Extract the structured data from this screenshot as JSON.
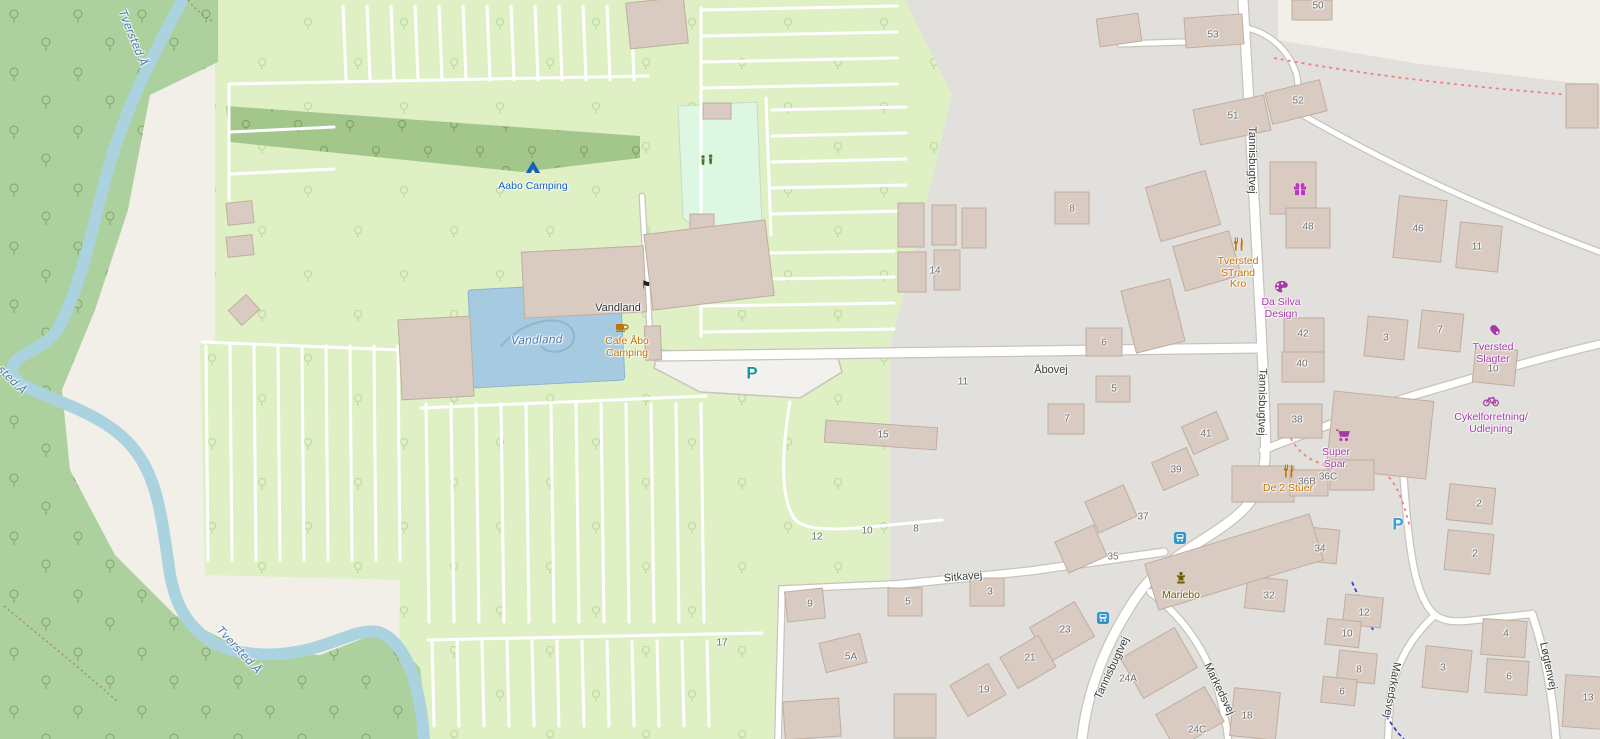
{
  "map": {
    "region_description": "Tversted camping and village street map",
    "colors": {
      "bg": "#f2efe9",
      "residential": "#e2e0dc",
      "camp": "#def0c4",
      "forest": "#add19e",
      "wood": "#a3c68b",
      "pitch": "#def7e2",
      "water": "#aad3df",
      "pool": "#a6cbe1",
      "building": "#d9cbc2",
      "buildingStroke": "#c0ad9d",
      "road": "#ffffff",
      "casing": "#c8c4bb",
      "parkingLot": "#f2f1ed",
      "pathRed": "#f08080",
      "pathBlue": "#3344cc",
      "track": "#ac8c4e",
      "num": "#6e6e6e",
      "roadLabel": "#3c3c3c",
      "waterLabel": "#4a78b0",
      "placeDark": "#333333",
      "poiOrange": "#c27400",
      "poiPurple": "#a53aa5",
      "poiBlue": "#1560bd",
      "poiGold": "#6b5d00",
      "gift": "#c72fc7",
      "tent": "#1d76b0",
      "playground": "#3e7d22",
      "bus": "#2f96c8",
      "statue": "#8a7500",
      "parkingTeal": "#18989e",
      "parkingBlue": "#3aa0d8",
      "treeForest": "#7ea368",
      "treeCamp": "#b9d89c",
      "treeWood": "#7d9c63"
    },
    "road_labels": [
      {
        "text": "Åbovej",
        "x": 1051,
        "y": 370,
        "a": -1
      },
      {
        "text": "Tannisbugtvej",
        "x": 1252,
        "y": 160,
        "a": 90
      },
      {
        "text": "Tannisbugtvej",
        "x": 1262,
        "y": 402,
        "a": 91
      },
      {
        "text": "Tannisbugtvej",
        "x": 1112,
        "y": 668,
        "a": -65
      },
      {
        "text": "Sitkavej",
        "x": 963,
        "y": 577,
        "a": -5
      },
      {
        "text": "Markedsvej",
        "x": 1219,
        "y": 689,
        "a": 64
      },
      {
        "text": "Markedsvej",
        "x": 1392,
        "y": 690,
        "a": 100
      },
      {
        "text": "Løgtenvej",
        "x": 1548,
        "y": 666,
        "a": 78
      }
    ],
    "water_labels": [
      {
        "text": "Tversted Å",
        "x": 133,
        "y": 38,
        "a": 68
      },
      {
        "text": "sted Å",
        "x": 12,
        "y": 380,
        "a": 45
      },
      {
        "text": "Tversted Å",
        "x": 239,
        "y": 650,
        "a": 47
      },
      {
        "text": "Vandland",
        "x": 537,
        "y": 340,
        "a": -2
      }
    ],
    "pois": [
      {
        "name": "aabo-camping",
        "icon": "tent-icon",
        "ix": 533,
        "iy": 167,
        "lines": [
          "Aabo Camping"
        ],
        "x": 533,
        "y": 186,
        "ck": "poiBlue"
      },
      {
        "name": "vandland-place",
        "lines": [
          "Vandland"
        ],
        "x": 618,
        "y": 308,
        "ck": "placeDark"
      },
      {
        "name": "cafe-abo-camping",
        "icon": "cafe-icon",
        "ix": 622,
        "iy": 327,
        "lines": [
          "Cafe Åbo",
          "Camping"
        ],
        "x": 627,
        "y": 341,
        "ck": "poiOrange"
      },
      {
        "name": "tversted-strand-kro",
        "icon": "restaurant-icon",
        "ix": 1238,
        "iy": 244,
        "lines": [
          "Tversted",
          "STrand",
          "Kro"
        ],
        "x": 1238,
        "y": 261,
        "ck": "poiOrange"
      },
      {
        "name": "da-silva-design",
        "icon": "palette-icon",
        "ix": 1281,
        "iy": 287,
        "lines": [
          "Da Silva",
          "Design"
        ],
        "x": 1281,
        "y": 302,
        "ck": "poiPurple"
      },
      {
        "name": "tversted-slagter",
        "icon": "butcher-icon",
        "ix": 1495,
        "iy": 330,
        "lines": [
          "Tversted",
          "Slagter"
        ],
        "x": 1493,
        "y": 347,
        "ck": "poiPurple"
      },
      {
        "name": "cykelforretning-udlejning",
        "icon": "bicycle-icon",
        "ix": 1491,
        "iy": 401,
        "lines": [
          "Cykelforretning/",
          "Udlejning"
        ],
        "x": 1491,
        "y": 417,
        "ck": "poiPurple"
      },
      {
        "name": "super-spar",
        "icon": "cart-icon",
        "ix": 1343,
        "iy": 435,
        "lines": [
          "Super",
          "Spar."
        ],
        "x": 1336,
        "y": 452,
        "ck": "poiPurple"
      },
      {
        "name": "de-2-stuer",
        "icon": "restaurant-icon",
        "ix": 1288,
        "iy": 471,
        "lines": [
          "De 2 Stuer"
        ],
        "x": 1288,
        "y": 488,
        "ck": "poiOrange"
      },
      {
        "name": "mariebo",
        "icon": "statue-icon",
        "ix": 1181,
        "iy": 578,
        "lines": [
          "Mariebo"
        ],
        "x": 1181,
        "y": 595,
        "ck": "poiGold"
      }
    ],
    "standalone_icons": [
      {
        "name": "playground-icon",
        "x": 707,
        "y": 160
      },
      {
        "name": "gift-icon",
        "x": 1300,
        "y": 189
      },
      {
        "name": "flag-icon",
        "x": 646,
        "y": 286,
        "glyph": "⚑"
      },
      {
        "name": "parking-icon",
        "x": 752,
        "y": 373,
        "glyph": "P",
        "ck": "parkingTeal"
      },
      {
        "name": "parking-icon",
        "x": 1398,
        "y": 524,
        "glyph": "P",
        "ck": "parkingBlue"
      },
      {
        "name": "bus-stop-icon",
        "x": 1180,
        "y": 538
      },
      {
        "name": "bus-stop-icon",
        "x": 1103,
        "y": 618
      }
    ],
    "house_numbers": [
      {
        "n": "53",
        "x": 1213,
        "y": 35
      },
      {
        "n": "50",
        "x": 1318,
        "y": 6
      },
      {
        "n": "52",
        "x": 1298,
        "y": 101
      },
      {
        "n": "51",
        "x": 1233,
        "y": 116
      },
      {
        "n": "8",
        "x": 1072,
        "y": 209
      },
      {
        "n": "48",
        "x": 1308,
        "y": 227
      },
      {
        "n": "46",
        "x": 1418,
        "y": 229
      },
      {
        "n": "11",
        "x": 1477,
        "y": 247
      },
      {
        "n": "14",
        "x": 935,
        "y": 271
      },
      {
        "n": "42",
        "x": 1303,
        "y": 334
      },
      {
        "n": "3",
        "x": 1386,
        "y": 338
      },
      {
        "n": "7",
        "x": 1440,
        "y": 330
      },
      {
        "n": "40",
        "x": 1302,
        "y": 364
      },
      {
        "n": "6",
        "x": 1104,
        "y": 343
      },
      {
        "n": "11",
        "x": 963,
        "y": 382
      },
      {
        "n": "5",
        "x": 1114,
        "y": 389
      },
      {
        "n": "10",
        "x": 1493,
        "y": 369
      },
      {
        "n": "38",
        "x": 1297,
        "y": 420
      },
      {
        "n": "7",
        "x": 1067,
        "y": 419
      },
      {
        "n": "41",
        "x": 1206,
        "y": 434
      },
      {
        "n": "15",
        "x": 883,
        "y": 435
      },
      {
        "n": "39",
        "x": 1176,
        "y": 470
      },
      {
        "n": "36B",
        "x": 1307,
        "y": 482
      },
      {
        "n": "36C",
        "x": 1328,
        "y": 477
      },
      {
        "n": "2",
        "x": 1479,
        "y": 504
      },
      {
        "n": "37",
        "x": 1143,
        "y": 517
      },
      {
        "n": "12",
        "x": 817,
        "y": 537
      },
      {
        "n": "10",
        "x": 867,
        "y": 531
      },
      {
        "n": "8",
        "x": 916,
        "y": 529
      },
      {
        "n": "35",
        "x": 1113,
        "y": 557
      },
      {
        "n": "34",
        "x": 1320,
        "y": 549
      },
      {
        "n": "3",
        "x": 990,
        "y": 592
      },
      {
        "n": "2",
        "x": 1475,
        "y": 554
      },
      {
        "n": "9",
        "x": 810,
        "y": 604
      },
      {
        "n": "5",
        "x": 908,
        "y": 602
      },
      {
        "n": "32",
        "x": 1269,
        "y": 596
      },
      {
        "n": "12",
        "x": 1364,
        "y": 613
      },
      {
        "n": "10",
        "x": 1347,
        "y": 634
      },
      {
        "n": "23",
        "x": 1065,
        "y": 630
      },
      {
        "n": "21",
        "x": 1030,
        "y": 658
      },
      {
        "n": "5A",
        "x": 851,
        "y": 657
      },
      {
        "n": "17",
        "x": 722,
        "y": 643
      },
      {
        "n": "8",
        "x": 1359,
        "y": 670
      },
      {
        "n": "6",
        "x": 1342,
        "y": 692
      },
      {
        "n": "3",
        "x": 1443,
        "y": 668
      },
      {
        "n": "4",
        "x": 1506,
        "y": 634
      },
      {
        "n": "6",
        "x": 1509,
        "y": 677
      },
      {
        "n": "13",
        "x": 1588,
        "y": 698
      },
      {
        "n": "19",
        "x": 984,
        "y": 690
      },
      {
        "n": "24A",
        "x": 1128,
        "y": 679
      },
      {
        "n": "24C",
        "x": 1197,
        "y": 730
      },
      {
        "n": "18",
        "x": 1247,
        "y": 716
      }
    ]
  }
}
